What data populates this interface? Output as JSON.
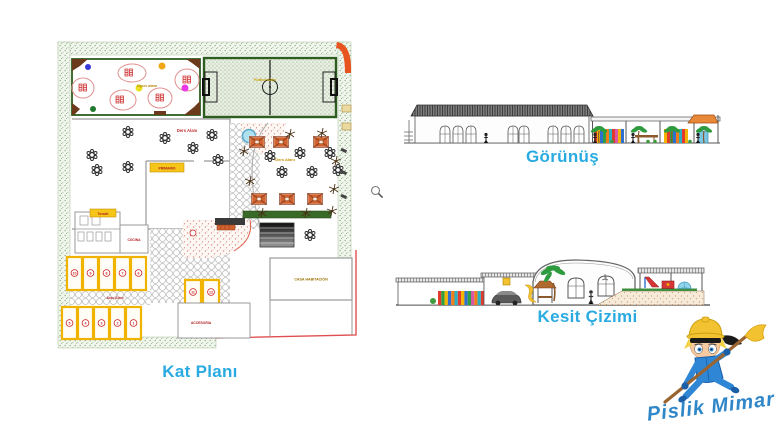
{
  "titles": {
    "plan": "Kat Planı",
    "elevation": "Görünüş",
    "section": "Kesit Çizimi"
  },
  "plan": {
    "labels": {
      "playground": "Oyun alanı",
      "field": "Futbol alanı",
      "classroom": "Ders Alanı",
      "primary_room": "PRIMARIO",
      "patio": "Ders Alanı",
      "toilet": "Tuvalet",
      "kitchen": "COCINA",
      "parking_area": "Araç Alanı",
      "house": "CASA HABITACIÓN",
      "annex": "ACCESORIA"
    },
    "parking_numbers": {
      "top": [
        "10",
        "9",
        "8",
        "7",
        "6"
      ],
      "bottom": [
        "5",
        "4",
        "3",
        "2",
        "1"
      ],
      "middle": [
        "11",
        "12"
      ]
    }
  },
  "mascot": {
    "signature": "Pislik Mimar"
  },
  "icons": {
    "cursor": "magnifier"
  },
  "colors": {
    "accent_title": "#29abe2",
    "signature_blue": "#2f86c8",
    "parking_yellow": "#f0b400",
    "pavilion_orange": "#d2622f",
    "hedge_green": "#9dbb90",
    "field_border_green": "#2e5e1f",
    "marker_red": "#cc2222",
    "label_red": "#b02020",
    "label_gold": "#b8860b",
    "boundary_red": "#e05050",
    "mascot_blue": "#2e86d4",
    "hat_yellow": "#f2c230"
  }
}
